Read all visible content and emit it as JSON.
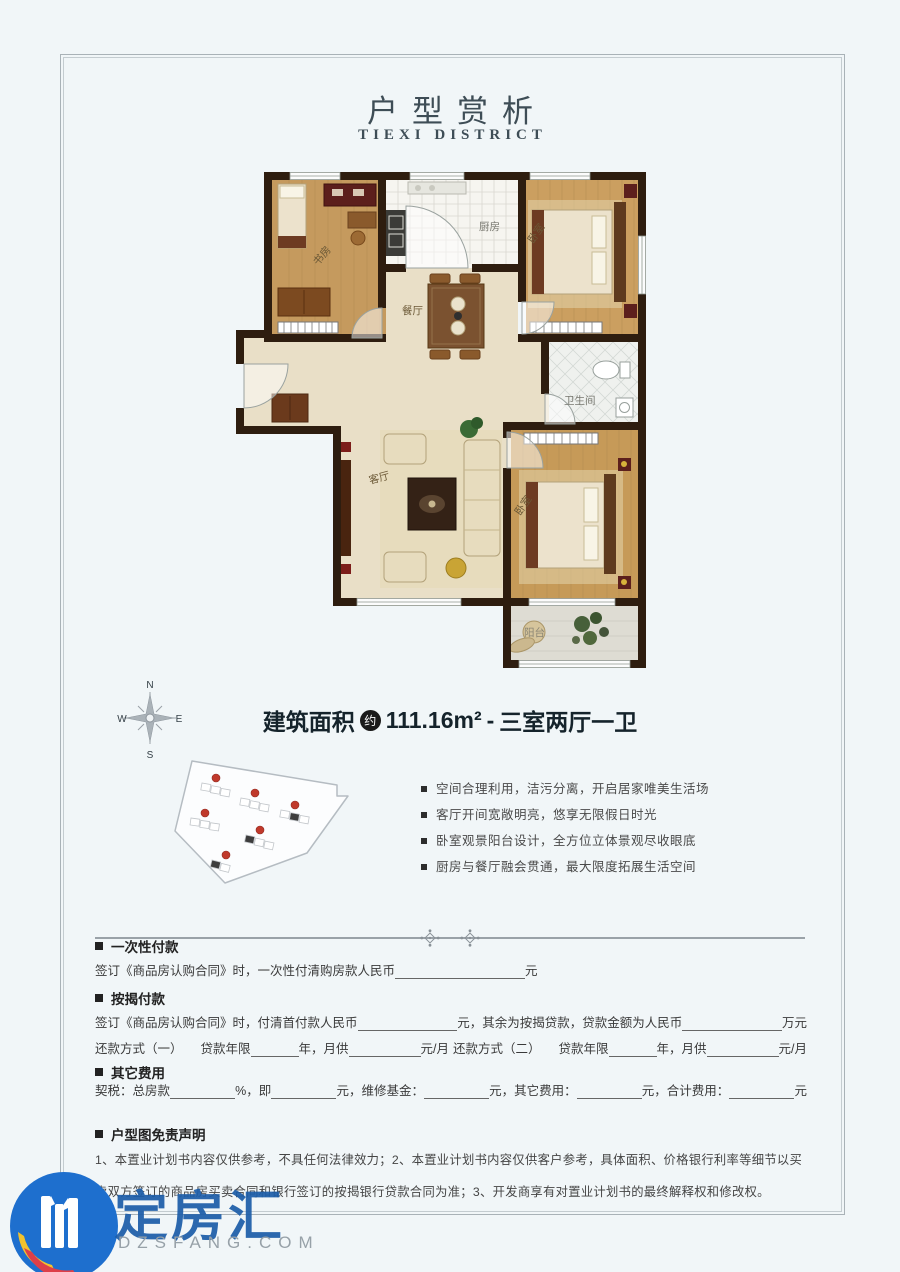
{
  "page": {
    "title": "户型赏析",
    "subtitle": "TIEXI DISTRICT"
  },
  "floorplan": {
    "rooms": {
      "study": "书房",
      "kitchen": "厨房",
      "dining": "餐厅",
      "bedroom_top": "卧室",
      "bathroom": "卫生间",
      "living": "客厅",
      "bedroom_bottom": "卧室",
      "balcony": "阳台"
    }
  },
  "compass": {
    "n": "N",
    "e": "E",
    "s": "S",
    "w": "W"
  },
  "area": {
    "label": "建筑面积",
    "approx": "约",
    "value": "111.16m²",
    "separator": "-",
    "layout": "三室两厅一卫"
  },
  "features": [
    "空间合理利用，洁污分离，开启居家唯美生活场",
    "客厅开间宽敞明亮，悠享无限假日时光",
    "卧室观景阳台设计，全方位立体景观尽收眼底",
    "厨房与餐厅融会贯通，最大限度拓展生活空间"
  ],
  "payment": {
    "once": {
      "heading": "一次性付款",
      "text_before_blank": "签订《商品房认购合同》时，一次性付清购房款人民币",
      "unit": "元"
    },
    "mortgage": {
      "heading": "按揭付款",
      "line1_a": "签订《商品房认购合同》时，付清首付款人民币",
      "line1_b": "元，其余为按揭贷款，贷款金额为人民币",
      "line1_c": "万元",
      "line2_a": "还款方式（一）",
      "line2_b": "贷款年限",
      "line2_c": "年，月供",
      "line2_d": "元/月",
      "line2_e": "还款方式（二）",
      "line2_f": "贷款年限",
      "line2_g": "年，月供",
      "line2_h": "元/月"
    },
    "other": {
      "heading": "其它费用",
      "a": "契税：总房款",
      "b": "%，即",
      "c": "元，维修基金：",
      "d": "元，其它费用：",
      "e": "元，合计费用：",
      "f": "元"
    }
  },
  "disclaimer": {
    "heading": "户型图免责声明",
    "line1": "1、本置业计划书内容仅供参考，不具任何法律效力；2、本置业计划书内容仅供客户参考，具体面积、价格银行利率等细节以买",
    "line2": "卖双方签订的商品房买卖合同和银行签订的按揭银行贷款合同为准；3、开发商享有对置业计划书的最终解释权和修改权。"
  },
  "watermark": {
    "name": "定房汇",
    "domain": "DZSFANG.COM"
  },
  "colors": {
    "wall": "#2e1d0f",
    "wood": "#c59a5e",
    "logo_blue": "#1e6fce",
    "marker_red": "#c0392b",
    "accent_dark": "#15232b"
  }
}
